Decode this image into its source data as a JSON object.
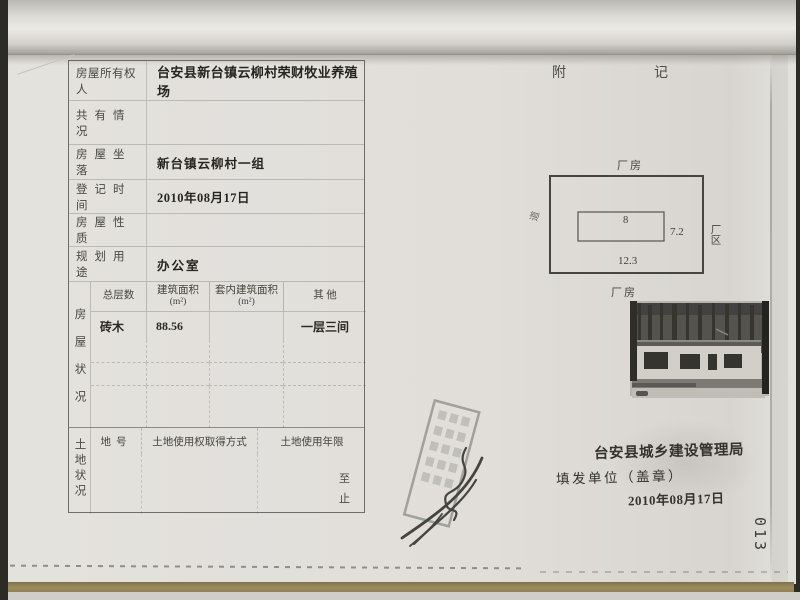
{
  "page": {
    "number": "013"
  },
  "registry": {
    "rows": [
      {
        "label": "房屋所有权人",
        "value": "台安县新台镇云柳村荣财牧业养殖场"
      },
      {
        "label": "共有情况",
        "value": ""
      },
      {
        "label": "房屋坐落",
        "value": "新台镇云柳村一组"
      },
      {
        "label": "登记时间",
        "value": "2010年08月17日"
      },
      {
        "label": "房屋性质",
        "value": ""
      },
      {
        "label": "规划用途",
        "value": "办公室"
      }
    ],
    "house": {
      "side_label": "房屋状况",
      "col_floors": "总层数",
      "col_area": "建筑面积",
      "col_inner_area": "套内建筑面积",
      "col_other": "其  他",
      "unit": "(m²)",
      "row": {
        "floors": "砖木",
        "area": "88.56",
        "inner_area": "",
        "other": "一层三间"
      }
    },
    "land": {
      "side_label": "土地状况",
      "col_parcel": "地号",
      "col_method": "土地使用权取得方式",
      "col_term": "土地使用年限",
      "mark_to": "至",
      "mark_end": "止"
    }
  },
  "annex": {
    "title_left": "附",
    "title_right": "记",
    "diagram": {
      "top_label": "厂房",
      "bottom_label": "厂房",
      "left_label": "道",
      "right_label": "厂区",
      "inner_width": "8",
      "side_depth": "7.2",
      "bottom_width": "12.3"
    },
    "footer": {
      "issuer": "台安县城乡建设管理局",
      "fill_unit": "填发单位（盖章）",
      "date": "2010年08月17日"
    }
  }
}
